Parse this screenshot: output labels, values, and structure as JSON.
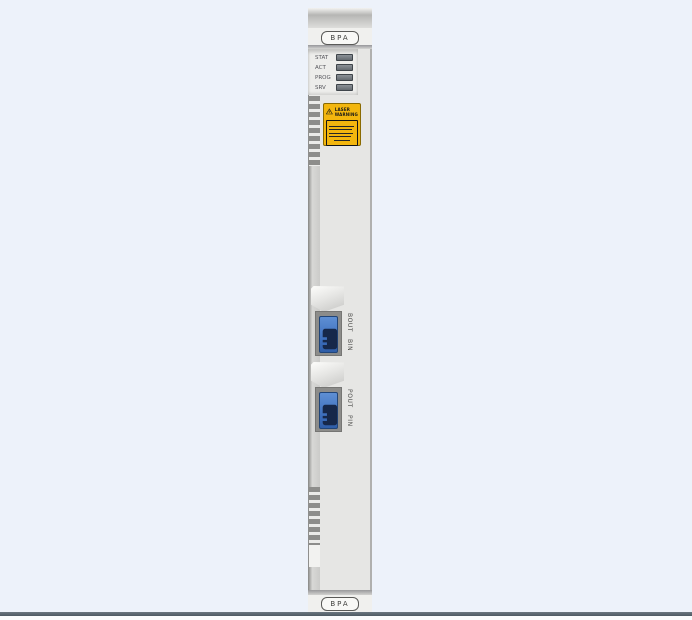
{
  "card": {
    "top_label": "BPA",
    "bottom_label": "BPA",
    "led_panel": {
      "leds": [
        {
          "label": "STAT"
        },
        {
          "label": "ACT"
        },
        {
          "label": "PROG"
        },
        {
          "label": "SRV"
        }
      ]
    },
    "laser_warning": {
      "line1": "LASER",
      "line2": "WARNING"
    },
    "ports": [
      {
        "out_label": "BOUT",
        "in_label": "BIN"
      },
      {
        "out_label": "POUT",
        "in_label": "PIN"
      }
    ],
    "colors": {
      "background": "#edf2fa",
      "faceplate": "#e6e6e4",
      "rail": "#cbcbc9",
      "led": "#757b81",
      "warning_bg": "#f3b60e",
      "connector_blue": "#3d76c6",
      "connector_icon": "#16284a",
      "floor_line": "#545f68"
    }
  }
}
